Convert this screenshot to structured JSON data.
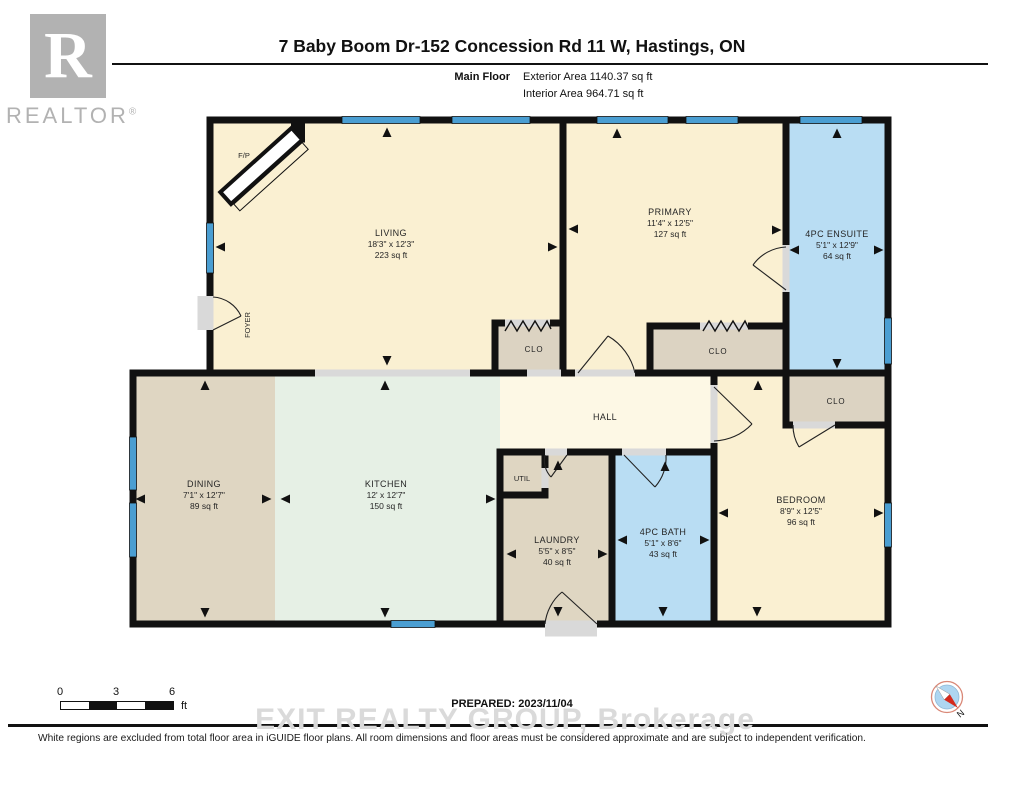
{
  "header": {
    "title": "7 Baby Boom Dr-152 Concession Rd 11 W, Hastings, ON",
    "floor_label": "Main Floor",
    "exterior_area": "Exterior Area 1140.37 sq ft",
    "interior_area": "Interior Area 964.71 sq ft",
    "logo": {
      "letter": "R",
      "word": "REALTOR",
      "registered": "®"
    }
  },
  "rooms": {
    "living": {
      "name": "LIVING",
      "dims": "18'3\" x 12'3\"",
      "area": "223 sq ft"
    },
    "primary": {
      "name": "PRIMARY",
      "dims": "11'4\" x 12'5\"",
      "area": "127 sq ft"
    },
    "ensuite": {
      "name": "4PC ENSUITE",
      "dims": "5'1\" x 12'9\"",
      "area": "64 sq ft"
    },
    "dining": {
      "name": "DINING",
      "dims": "7'1\" x 12'7\"",
      "area": "89 sq ft"
    },
    "kitchen": {
      "name": "KITCHEN",
      "dims": "12' x 12'7\"",
      "area": "150 sq ft"
    },
    "laundry": {
      "name": "LAUNDRY",
      "dims": "5'5\" x 8'5\"",
      "area": "40 sq ft"
    },
    "bath": {
      "name": "4PC BATH",
      "dims": "5'1\" x 8'6\"",
      "area": "43 sq ft"
    },
    "bedroom": {
      "name": "BEDROOM",
      "dims": "8'9\" x 12'5\"",
      "area": "96 sq ft"
    }
  },
  "labels": {
    "hall": "HALL",
    "foyer": "FOYER",
    "util": "UTIL",
    "fireplace": "F/P",
    "clo": "CLO"
  },
  "scale": {
    "tick0": "0",
    "tick1": "3",
    "tick2": "6",
    "unit": "ft",
    "north": "N"
  },
  "footer": {
    "prepared": "PREPARED: 2023/11/04",
    "watermark": "EXIT REALTY GROUP, Brokerage",
    "disclaimer": "White regions are excluded from total floor area in iGUIDE floor plans. All room dimensions and floor areas must be considered approximate and are subject to independent verification."
  },
  "colors": {
    "wall": "#111111",
    "window_blue": "#4a9ed2",
    "wet_room_blue": "#b9ddf3",
    "cream_room": "#faf0d2",
    "hall_cream": "#fdf8e5",
    "tan_room": "#dfd6c2",
    "kitchen_mint": "#e6f0e5",
    "threshold_gray": "#d9d9d9",
    "logo_gray": "#b2b2b2",
    "watermark_gray": "#dadada",
    "compass_ring": "#d98877",
    "compass_disc": "#aed6f1",
    "compass_red": "#d42b1e"
  }
}
